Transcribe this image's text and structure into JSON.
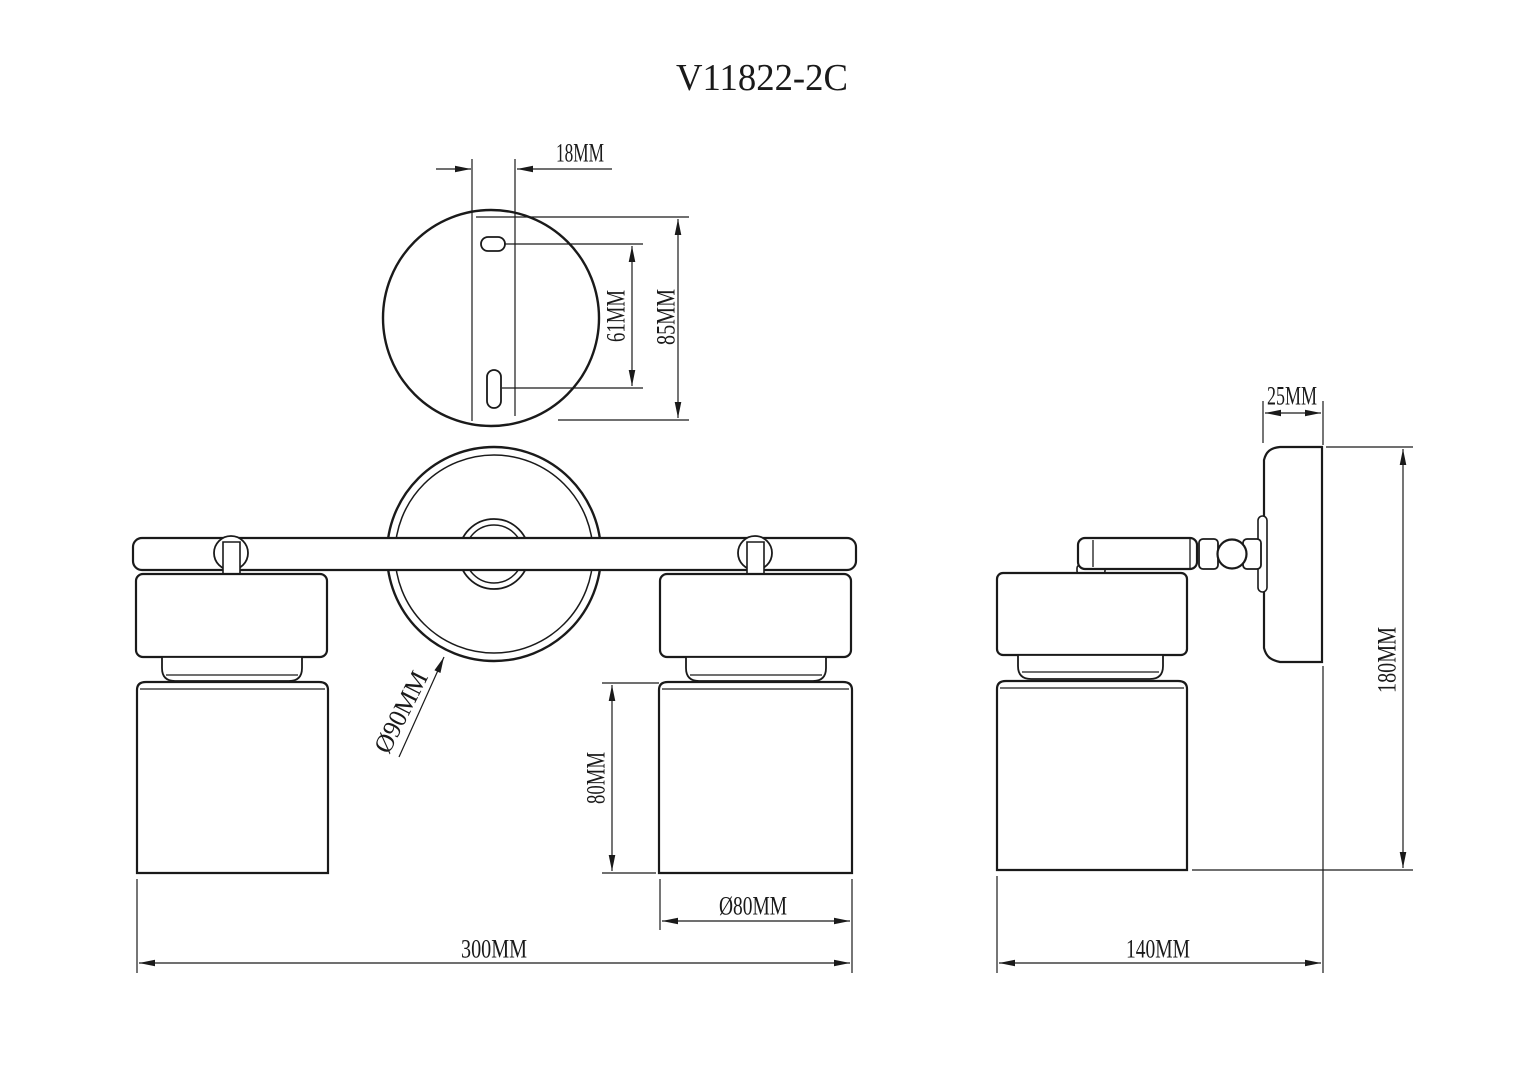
{
  "title": "V11822-2C",
  "colors": {
    "line": "#1a1a1a",
    "background": "#ffffff"
  },
  "top_view": {
    "dim_hole_offset": "18MM",
    "dim_slot_spacing": "61MM",
    "dim_plate_height": "85MM"
  },
  "front_view": {
    "dim_backplate_diameter": "Ø90MM",
    "dim_shade_height": "80MM",
    "dim_shade_diameter": "Ø80MM",
    "dim_overall_width": "300MM"
  },
  "side_view": {
    "dim_plate_depth": "25MM",
    "dim_overall_height": "180MM",
    "dim_overall_depth": "140MM"
  }
}
